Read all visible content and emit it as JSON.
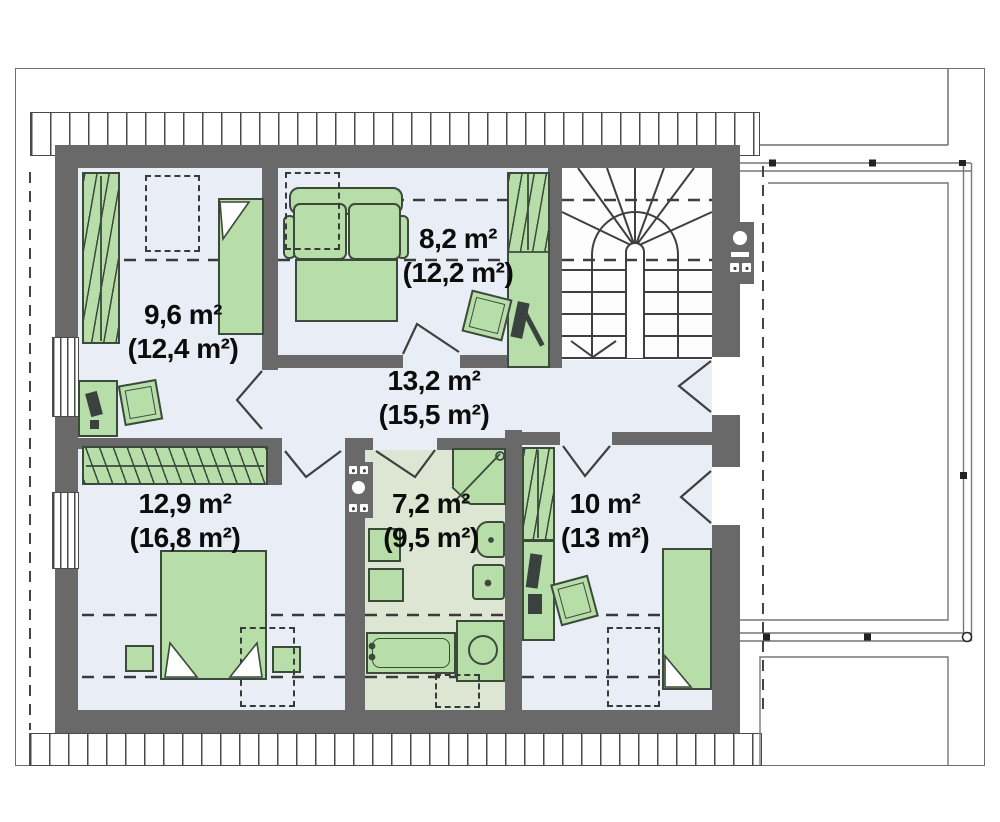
{
  "plan_title": "attic floor plan",
  "rooms": [
    {
      "id": "bedroom-top-left",
      "area_label": "9,6 m²",
      "area_total_label": "(12,4 m²)"
    },
    {
      "id": "bedroom-top-center",
      "area_label": "8,2 m²",
      "area_total_label": "(12,2 m²)"
    },
    {
      "id": "hall",
      "area_label": "13,2 m²",
      "area_total_label": "(15,5 m²)"
    },
    {
      "id": "bedroom-bottom-left",
      "area_label": "12,9 m²",
      "area_total_label": "(16,8 m²)"
    },
    {
      "id": "bathroom",
      "area_label": "7,2 m²",
      "area_total_label": "(9,5 m²)"
    },
    {
      "id": "bedroom-bottom-right",
      "area_label": "10 m²",
      "area_total_label": "(13 m²)"
    }
  ],
  "furniture": {
    "bedroom-top-left": [
      "wardrobe",
      "single-bed",
      "desk",
      "armchair",
      "skylight"
    ],
    "bedroom-top-center": [
      "sofa-bed",
      "wardrobe",
      "armchair",
      "skylight"
    ],
    "bedroom-bottom-left": [
      "wardrobe",
      "double-bed",
      "nightstand",
      "nightstand",
      "skylight"
    ],
    "bathroom": [
      "shower",
      "washbasin",
      "toilet",
      "washer",
      "washer",
      "bathtub",
      "sink-counter",
      "chimney",
      "skylight"
    ],
    "bedroom-bottom-right": [
      "wardrobe",
      "desk",
      "armchair",
      "single-bed",
      "skylight"
    ],
    "hall": [
      "staircase",
      "balcony-door"
    ],
    "exterior": [
      "balcony",
      "terrace",
      "roof-edge",
      "chimney"
    ]
  },
  "colors": {
    "wall": "#696969",
    "floor": "#e9eef6",
    "stair_floor": "#fdfdfd",
    "bathroom_floor": "#dde6d2",
    "furniture": "#b7dda8",
    "furniture_line": "#3c4a3c",
    "line": "#3f3f3f",
    "frame": "#6e6e6e",
    "hatch": "#4a4a4a",
    "dash": "#3a3a3a",
    "terrace_line": "#777777"
  }
}
